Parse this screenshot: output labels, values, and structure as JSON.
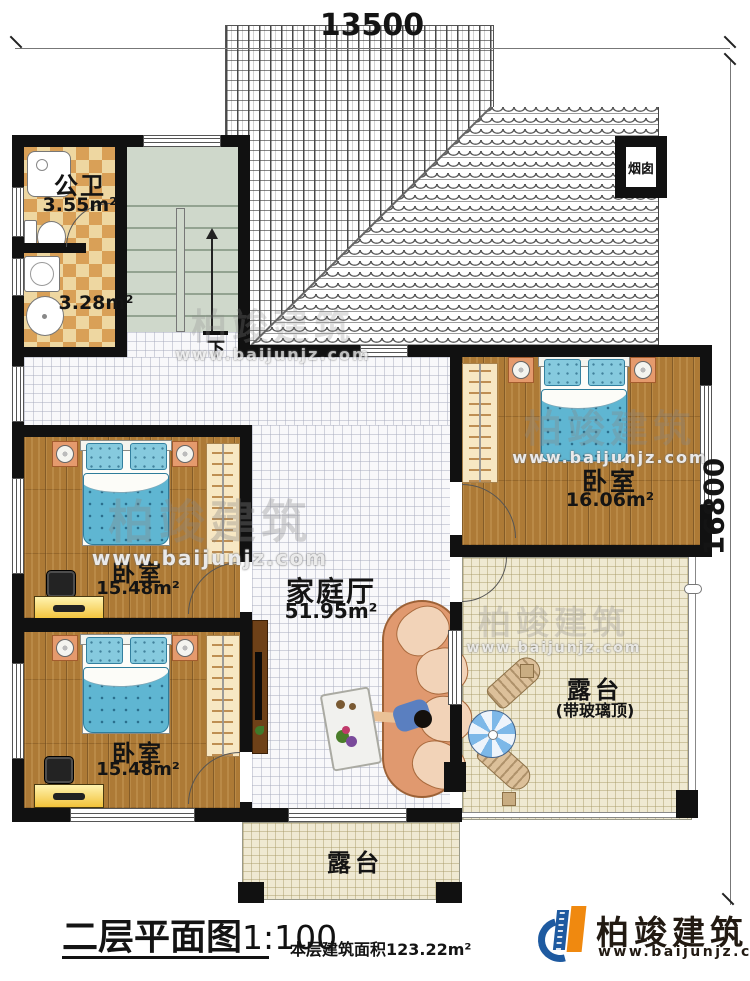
{
  "dims": {
    "width_label": "13500",
    "height_label": "16800"
  },
  "rooms": {
    "bath": {
      "name": "公卫",
      "area": "3.55m²"
    },
    "laundry": {
      "area": "3.28m²"
    },
    "bedroom_top_right": {
      "name": "卧室",
      "area": "16.06m²"
    },
    "bedroom_mid_left": {
      "name": "卧室",
      "area": "15.48m²"
    },
    "bedroom_bottom_left": {
      "name": "卧室",
      "area": "15.48m²"
    },
    "family_hall": {
      "name": "家庭厅",
      "area": "51.95m²"
    },
    "terrace_right": {
      "name": "露台",
      "note": "(带玻璃顶)"
    },
    "terrace_bottom": {
      "name": "露台"
    }
  },
  "annotations": {
    "chimney": "烟囱",
    "stairs_down": "下"
  },
  "footer": {
    "title": "二层平面图",
    "scale": "1:100",
    "area_note": "本层建筑面积123.22m²"
  },
  "branding": {
    "name": "柏竣建筑",
    "site": "www.baijunjz.com"
  },
  "watermark": {
    "text": "柏竣建筑",
    "site": "www.baijunjz.com"
  },
  "colors": {
    "wall": "#111111",
    "wood": "#ad7a36",
    "terrace": "#efe9d2",
    "stairs": "#cfd8cb",
    "quilt": "#5fb6d2",
    "checker": "#d9a057",
    "logo_blue": "#1e5aa0",
    "logo_orange": "#f0890f"
  }
}
